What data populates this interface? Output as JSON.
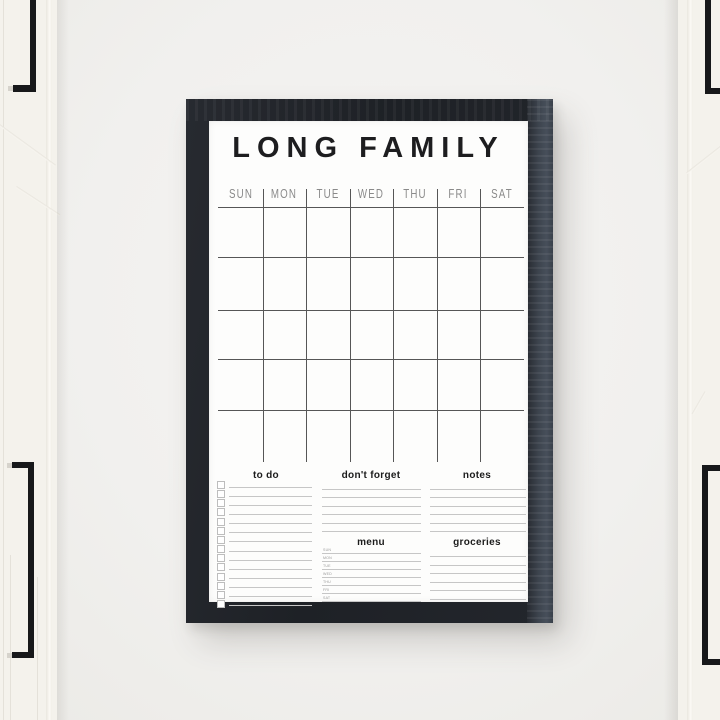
{
  "board": {
    "title": "LONG FAMILY",
    "day_header": [
      "SUN",
      "MON",
      "TUE",
      "WED",
      "THU",
      "FRI",
      "SAT"
    ],
    "calendar_grid": {
      "columns": 7,
      "week_rows": 5
    },
    "sections": {
      "todo": {
        "label": "to do",
        "rows": 14,
        "has_checkboxes": true
      },
      "dont_forget": {
        "label": "don't forget",
        "ruled_lines": 6
      },
      "notes": {
        "label": "notes",
        "ruled_lines": 6
      },
      "menu": {
        "label": "menu",
        "day_labels": [
          "SUN",
          "MON",
          "TUE",
          "WED",
          "THU",
          "FRI",
          "SAT"
        ]
      },
      "groceries": {
        "label": "groceries",
        "ruled_lines": 6
      }
    }
  },
  "colors": {
    "wall": "#f1f0ee",
    "door": "#f4f2ec",
    "frame_dark": "#1e2126",
    "frame_grain": "#3d444e",
    "paper": "#fdfdfc",
    "grid_line": "#565656",
    "day_label": "#8a8a8a",
    "title_text": "#1d1d1f",
    "section_title": "#1c1c1c",
    "rule_line": "#c6c6c6",
    "checkbox_border": "#bdbdbd",
    "menu_day_label": "#9a9a9a",
    "handle": "#17181a"
  }
}
